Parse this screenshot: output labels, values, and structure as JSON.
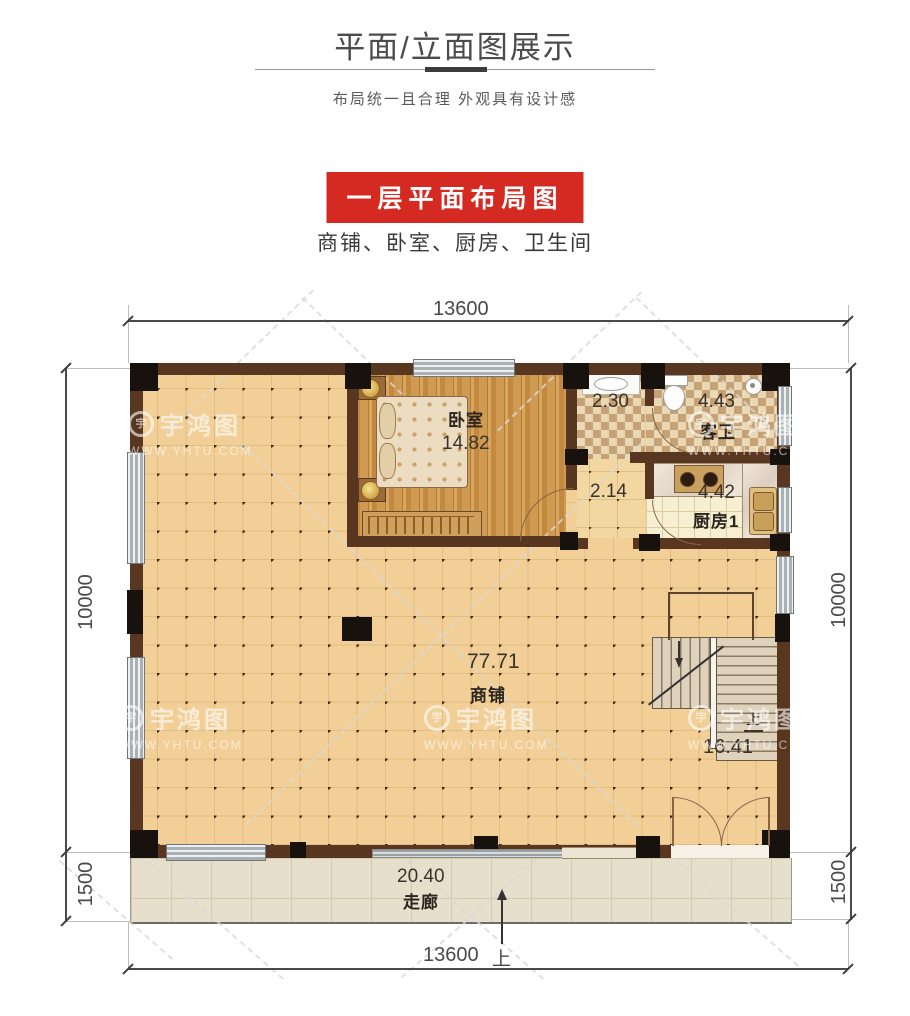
{
  "header": {
    "title": "平面/立面图展示",
    "subtitle": "布局统一且合理 外观具有设计感",
    "banner_title": "一层平面布局图",
    "rooms_line": "商铺、卧室、厨房、卫生间"
  },
  "plan": {
    "rooms": {
      "bedroom": {
        "name": "卧室",
        "area": "14.82"
      },
      "washroom": {
        "area": "2.30"
      },
      "guest_bath": {
        "name": "客卫",
        "area": "4.43"
      },
      "passage": {
        "area": "2.14"
      },
      "kitchen": {
        "name": "厨房1",
        "area": "4.42"
      },
      "shop": {
        "name": "商铺",
        "area": "77.71"
      },
      "stairs": {
        "area": "16.41",
        "up_label": "上"
      },
      "corridor": {
        "name": "走廊",
        "area": "20.40"
      }
    },
    "dimensions": {
      "top_width": "13600",
      "bottom_width": "13600",
      "left_height": "10000",
      "right_height": "10000",
      "left_corridor_depth": "1500",
      "right_corridor_depth": "1500",
      "entry_direction_label": "上"
    }
  },
  "watermark": {
    "brand": "宇鸿图",
    "url": "WWW.YHTU.COM"
  },
  "colors": {
    "banner_red": "#d42a22",
    "wall_brown": "#583620",
    "column_black": "#17120d",
    "shop_floor_tan": "#f0cd95",
    "corridor_beige": "#e5decb",
    "title_gray": "#4c4c4c"
  }
}
